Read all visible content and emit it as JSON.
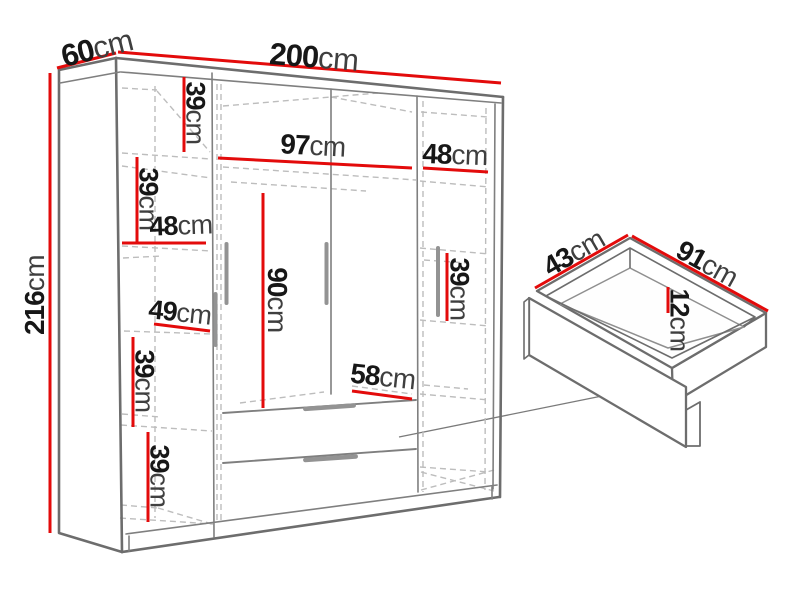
{
  "page": {
    "background": "#ffffff",
    "description": "Dimension diagram of a four-door wardrobe with shelves and drawers, plus a 3D detail view of a pull-out drawer"
  },
  "colors": {
    "dimension_red": "#e30b0b",
    "outline_gray": "#6d6d6d",
    "dashed_gray": "#bdbdbd",
    "label_black": "#171717"
  },
  "dims": {
    "overall_width": {
      "num": "200",
      "unit": "cm"
    },
    "overall_depth": {
      "num": "60",
      "unit": "cm"
    },
    "overall_height": {
      "num": "216",
      "unit": "cm"
    },
    "left_shelf_1": {
      "num": "39",
      "unit": "cm"
    },
    "left_shelf_2": {
      "num": "39",
      "unit": "cm"
    },
    "left_width": {
      "num": "48",
      "unit": "cm"
    },
    "left_width_lower": {
      "num": "49",
      "unit": "cm"
    },
    "left_shelf_3": {
      "num": "39",
      "unit": "cm"
    },
    "left_shelf_4": {
      "num": "39",
      "unit": "cm"
    },
    "center_width": {
      "num": "97",
      "unit": "cm"
    },
    "center_hanging_height": {
      "num": "90",
      "unit": "cm"
    },
    "center_above_drawers": {
      "num": "58",
      "unit": "cm"
    },
    "right_width": {
      "num": "48",
      "unit": "cm"
    },
    "right_shelf": {
      "num": "39",
      "unit": "cm"
    },
    "drawer_depth": {
      "num": "43",
      "unit": "cm"
    },
    "drawer_width": {
      "num": "91",
      "unit": "cm"
    },
    "drawer_height": {
      "num": "12",
      "unit": "cm"
    }
  }
}
